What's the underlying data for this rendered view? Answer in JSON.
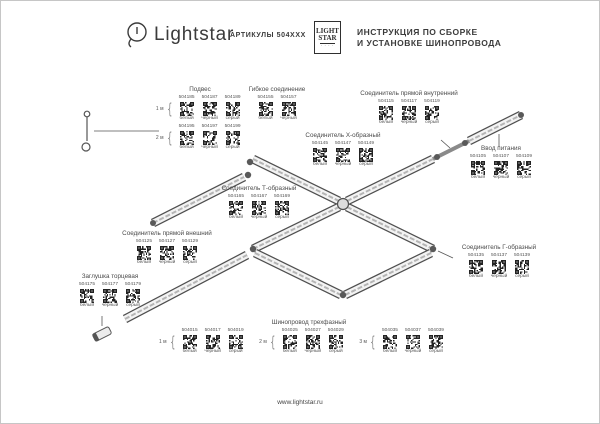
{
  "header": {
    "brand": "Lightstar",
    "articles_label": "АРТИКУЛЫ 504XXX",
    "logo_box_line1": "LIGHT",
    "logo_box_line2": "STAR",
    "title_line1": "ИНСТРУКЦИЯ ПО СБОРКЕ",
    "title_line2": "И УСТАНОВКЕ ШИНОПРОВОДА"
  },
  "footer": {
    "url": "www.lightstar.ru"
  },
  "groups": {
    "podves": {
      "title": "Подвес",
      "rows": [
        {
          "label": "1 м",
          "items": [
            {
              "art": "504185",
              "color": "белый"
            },
            {
              "art": "504187",
              "color": "черный"
            },
            {
              "art": "504189",
              "color": "серый"
            }
          ]
        },
        {
          "label": "2 м",
          "items": [
            {
              "art": "504195",
              "color": "белый"
            },
            {
              "art": "504197",
              "color": "черный"
            },
            {
              "art": "504199",
              "color": "серый"
            }
          ]
        }
      ]
    },
    "gibkoe": {
      "title": "Гибкое соединение",
      "rows": [
        {
          "label": "",
          "items": [
            {
              "art": "504155",
              "color": "белый"
            },
            {
              "art": "504157",
              "color": "черный"
            }
          ]
        }
      ]
    },
    "pryamoy_vnutr": {
      "title": "Соединитель прямой внутренний",
      "rows": [
        {
          "label": "",
          "items": [
            {
              "art": "504115",
              "color": "белый"
            },
            {
              "art": "504117",
              "color": "черный"
            },
            {
              "art": "504119",
              "color": "серый"
            }
          ]
        }
      ]
    },
    "vvod": {
      "title": "Ввод питания",
      "rows": [
        {
          "label": "",
          "items": [
            {
              "art": "504105",
              "color": "белый"
            },
            {
              "art": "504107",
              "color": "черный"
            },
            {
              "art": "504109",
              "color": "серый"
            }
          ]
        }
      ]
    },
    "x_conn": {
      "title": "Соединитель Х-образный",
      "rows": [
        {
          "label": "",
          "items": [
            {
              "art": "504145",
              "color": "белый"
            },
            {
              "art": "504147",
              "color": "черный"
            },
            {
              "art": "504149",
              "color": "серый"
            }
          ]
        }
      ]
    },
    "t_conn": {
      "title": "Соединитель Т-образный",
      "rows": [
        {
          "label": "",
          "items": [
            {
              "art": "504165",
              "color": "белый"
            },
            {
              "art": "504167",
              "color": "черный"
            },
            {
              "art": "504169",
              "color": "серый"
            }
          ]
        }
      ]
    },
    "pryamoy_vnesh": {
      "title": "Соединитель прямой внешний",
      "rows": [
        {
          "label": "",
          "items": [
            {
              "art": "504125",
              "color": "белый"
            },
            {
              "art": "504127",
              "color": "черный"
            },
            {
              "art": "504129",
              "color": "серый"
            }
          ]
        }
      ]
    },
    "zaglushka": {
      "title": "Заглушка торцевая",
      "rows": [
        {
          "label": "",
          "items": [
            {
              "art": "504175",
              "color": "белый"
            },
            {
              "art": "504177",
              "color": "черный"
            },
            {
              "art": "504179",
              "color": "серый"
            }
          ]
        }
      ]
    },
    "g_conn": {
      "title": "Соединитель Г-образный",
      "rows": [
        {
          "label": "",
          "items": [
            {
              "art": "504135",
              "color": "белый"
            },
            {
              "art": "504137",
              "color": "черный"
            },
            {
              "art": "504139",
              "color": "серый"
            }
          ]
        }
      ]
    },
    "shinoprovod": {
      "title": "Шинопровод трехфазный",
      "rows": [
        {
          "label": "1 м",
          "items": [
            {
              "art": "504015",
              "color": "белый"
            },
            {
              "art": "504017",
              "color": "черный"
            },
            {
              "art": "504019",
              "color": "серый"
            }
          ]
        },
        {
          "label": "2 м",
          "items": [
            {
              "art": "504025",
              "color": "белый"
            },
            {
              "art": "504027",
              "color": "черный"
            },
            {
              "art": "504029",
              "color": "серый"
            }
          ]
        },
        {
          "label": "3 м",
          "items": [
            {
              "art": "504035",
              "color": "белый"
            },
            {
              "art": "504037",
              "color": "черный"
            },
            {
              "art": "504039",
              "color": "серый"
            }
          ]
        }
      ]
    }
  }
}
